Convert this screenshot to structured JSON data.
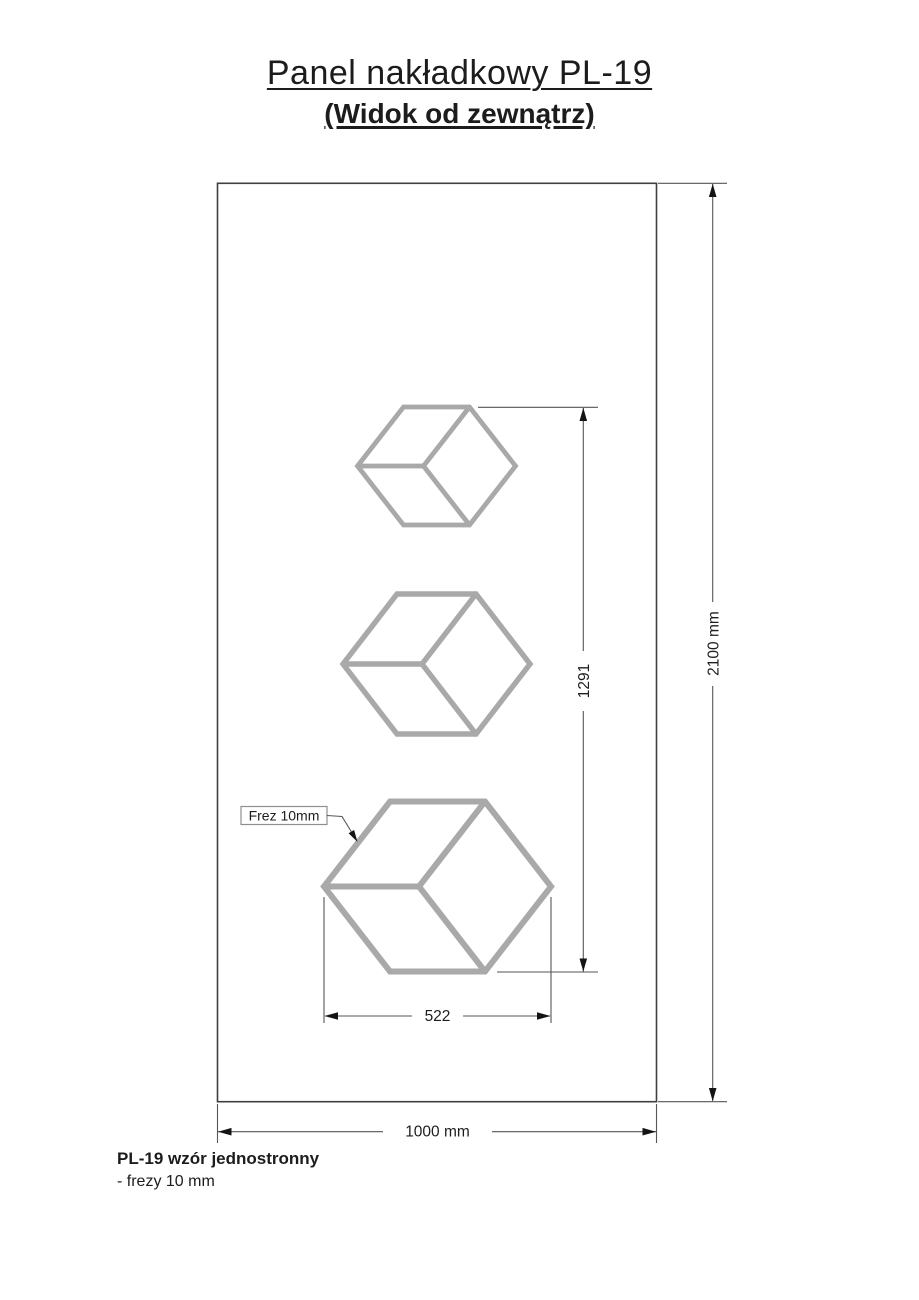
{
  "header": {
    "title": "Panel nakładkowy PL-19",
    "subtitle": "(Widok od zewnątrz)"
  },
  "drawing": {
    "dim_panel_height": "2100 mm",
    "dim_panel_width": "1000 mm",
    "dim_pattern_height": "1291",
    "dim_cube_width": "522",
    "callout_mill": "Frez 10mm"
  },
  "footer": {
    "model": "PL-19 wzór jednostronny",
    "note": "- frezy 10 mm"
  },
  "colors": {
    "background": "#ffffff",
    "panel_stroke": "#3f3f3f",
    "cube_stroke": "#a9a9a9",
    "dimension_line": "#565656",
    "arrow_fill": "#141414",
    "text": "#1c1c1c"
  }
}
